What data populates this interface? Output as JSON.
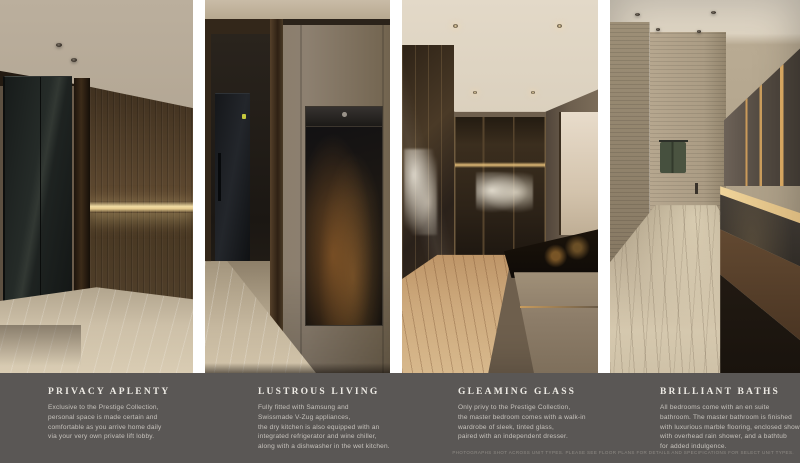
{
  "theme": {
    "page_bg": "#ffffff",
    "band_color": "#5a5755",
    "title_color": "#edeae4",
    "body_color": "#c7c3bd",
    "disclaimer_color": "#8f8b85"
  },
  "panels": [
    {
      "title": "PRIVACY APLENTY",
      "body": "Exclusive to the Prestige Collection,\npersonal space is made certain and\ncomfortable as you arrive home daily\nvia your very own private lift lobby."
    },
    {
      "title": "LUSTROUS LIVING",
      "body": "Fully fitted with Samsung and\nSwissmade V-Zug appliances,\nthe dry kitchen is also equipped with an\nintegrated refrigerator and wine chiller,\nalong with a dishwasher in the wet kitchen."
    },
    {
      "title": "GLEAMING GLASS",
      "body": "Only privy to the Prestige Collection,\nthe master bedroom comes with a walk-in\nwardrobe of sleek, tinted glass,\npaired with an independent dresser."
    },
    {
      "title": "BRILLIANT BATHS",
      "body": "All bedrooms come with an en suite\nbathroom. The master bathroom is finished\nwith luxurious marble flooring, enclosed shower\nwith overhead rain shower, and a bathtub\nfor added indulgence."
    }
  ],
  "disclaimer": "PHOTOGRAPHS SHOT ACROSS UNIT TYPES. PLEASE SEE FLOOR PLANS FOR DETAILS AND SPECIFICATIONS FOR SELECT UNIT TYPES."
}
